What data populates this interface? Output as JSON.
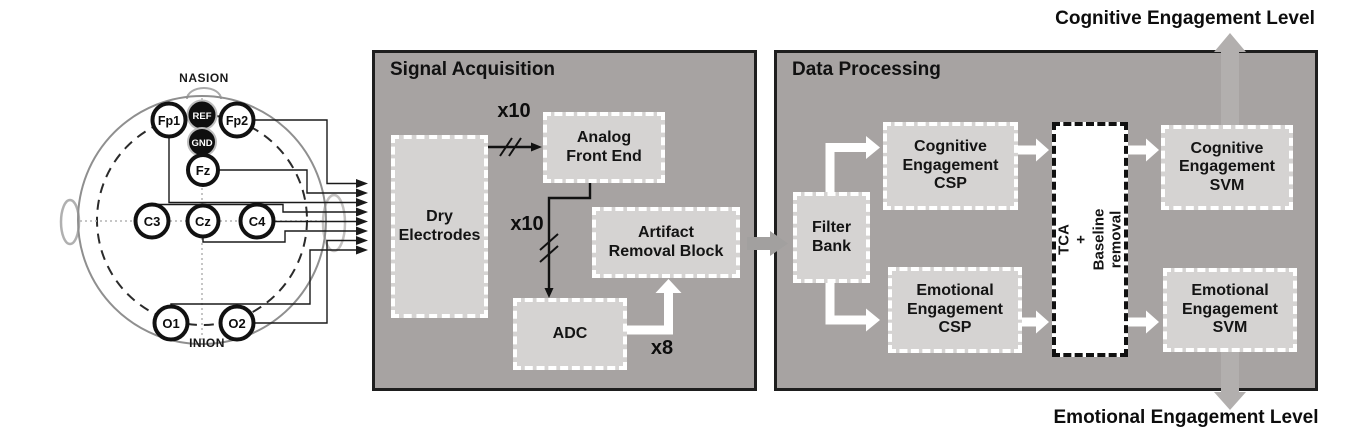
{
  "head_diagram": {
    "nasion": "NASION",
    "inion": "INION",
    "electrodes": {
      "fp1": "Fp1",
      "ref": "REF",
      "fp2": "Fp2",
      "gnd": "GND",
      "fz": "Fz",
      "c3": "C3",
      "cz": "Cz",
      "c4": "C4",
      "o1": "O1",
      "o2": "O2"
    }
  },
  "signal_acquisition": {
    "title": "Signal Acquisition",
    "dry_electrodes": "Dry\nElectrodes",
    "analog_front_end": "Analog\nFront End",
    "artifact_removal": "Artifact\nRemoval Block",
    "adc": "ADC",
    "x10_afe": "x10",
    "x10_adc": "x10",
    "x8": "x8"
  },
  "data_processing": {
    "title": "Data Processing",
    "filter_bank": "Filter\nBank",
    "cognitive_csp": "Cognitive\nEngagement\nCSP",
    "emotional_csp": "Emotional\nEngagement\nCSP",
    "tca_baseline": "TCA\n+\nBaseline removal",
    "cognitive_svm": "Cognitive\nEngagement\nSVM",
    "emotional_svm": "Emotional\nEngagement\nSVM"
  },
  "outputs": {
    "cognitive": "Cognitive Engagement Level",
    "emotional": "Emotional Engagement Level"
  },
  "colors": {
    "panel_bg": "#a7a3a2",
    "box_bg": "#d5d3d2",
    "panel_border": "#1e1e1e",
    "white_arrow": "#ffffff",
    "gray_arrow": "#b2afae"
  }
}
